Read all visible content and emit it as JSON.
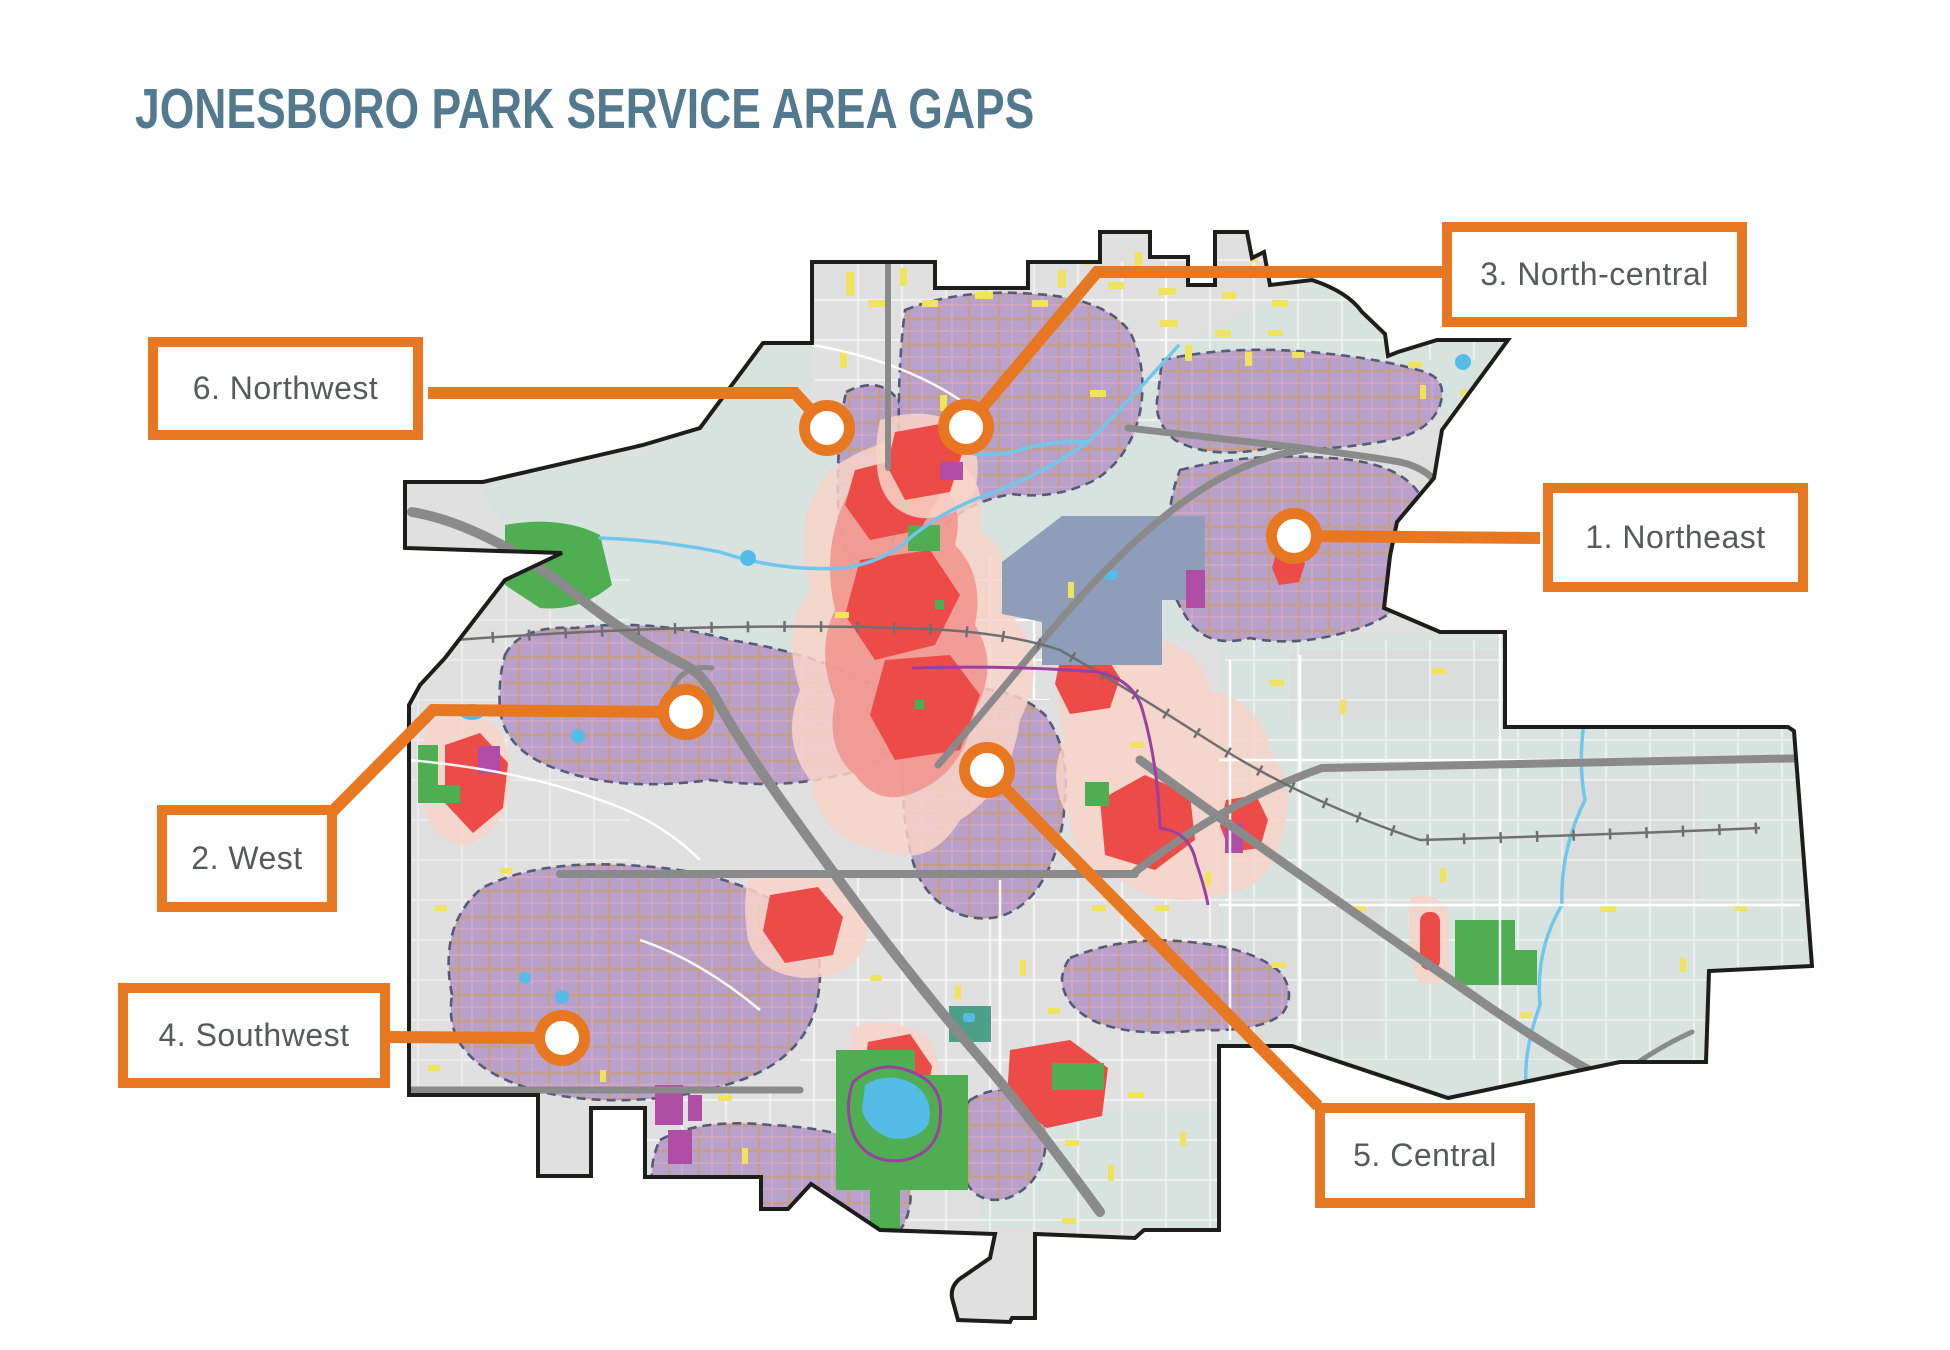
{
  "title": "JONESBORO PARK SERVICE AREA GAPS",
  "map_name": "Jonesboro city park service area map",
  "callouts": {
    "northeast": {
      "number": "1",
      "label": "1. Northeast"
    },
    "west": {
      "number": "2",
      "label": "2. West"
    },
    "north_central": {
      "number": "3",
      "label": "3. North-central"
    },
    "southwest": {
      "number": "4",
      "label": "4. Southwest"
    },
    "central": {
      "number": "5",
      "label": "5. Central"
    },
    "northwest": {
      "number": "6",
      "label": "6. Northwest"
    }
  },
  "colors": {
    "orange": "#E87722",
    "label_ink": "#58595B",
    "title_blue": "#53798F",
    "boundary_ink": "#1D1D1B",
    "base_gray": "#E0E0E0",
    "teal_zone": "#D8E3DF",
    "gap_purple": "#B69DC9",
    "gap_border": "#4C5472",
    "gap_road_tan": "#C49B82",
    "gap_road_pink": "#D3A6C3",
    "heat_core": "#EC4B47",
    "heat_mid": "#F0928C",
    "heat_pale": "#F8D3C8",
    "park_green": "#4EAE51",
    "park_teal": "#4E9F87",
    "water_blue": "#55BCE8",
    "stream_blue": "#6FC7EC",
    "road_gray": "#8A8A8A",
    "rail_gray": "#6F6F6F",
    "road_white": "#FFFFFF",
    "trail_purple": "#9B3FA0",
    "parcel_magenta": "#B04DA4",
    "campus_slate": "#8E9DBA",
    "street_yellow": "#EFE45C",
    "patch_gray": "#DCDCDC"
  }
}
